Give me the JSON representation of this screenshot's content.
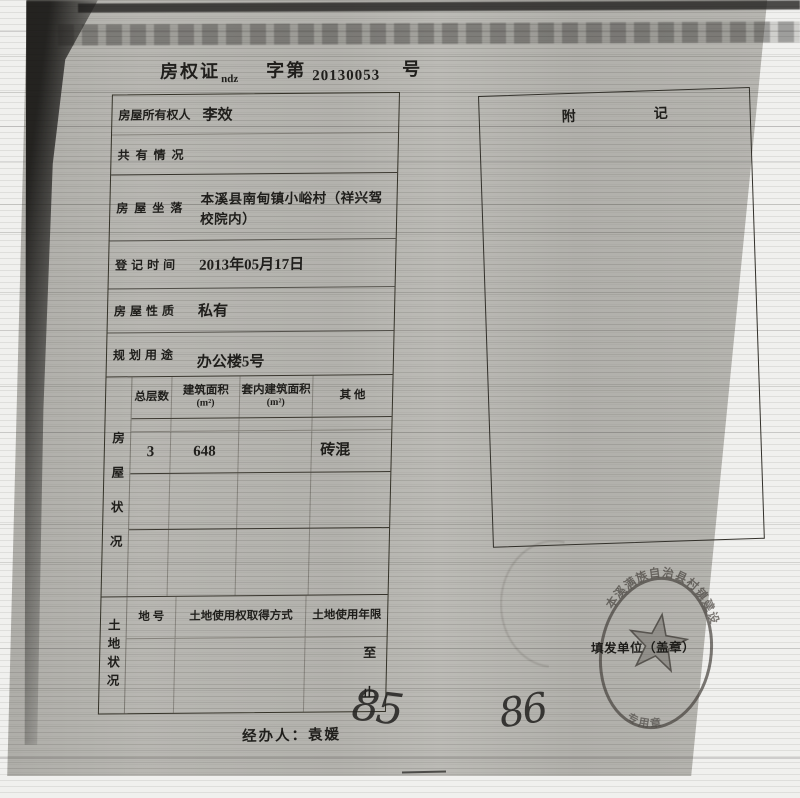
{
  "title": {
    "prefix": "房权证",
    "sub": "ndz",
    "middle": "字第",
    "number": "20130053",
    "suffix": "号"
  },
  "left_table": {
    "rows": [
      {
        "label": "房屋所有权人",
        "value": "李效"
      },
      {
        "label": "共有情况",
        "value": ""
      },
      {
        "label": "房屋坐落",
        "value": "本溪县南甸镇小峪村（祥兴驾校院内）"
      },
      {
        "label": "登记时间",
        "value": "2013年05月17日"
      },
      {
        "label": "房屋性质",
        "value": "私有"
      },
      {
        "label": "规划用途",
        "value": "办公楼5号"
      }
    ],
    "house_section": {
      "side_label": "房屋状况",
      "columns": [
        {
          "line1": "总层数",
          "line2": ""
        },
        {
          "line1": "建筑面积",
          "line2": "(m²)"
        },
        {
          "line1": "套内建筑面积",
          "line2": "(m²)"
        },
        {
          "line1": "其 他",
          "line2": ""
        }
      ],
      "values": [
        "3",
        "648",
        "",
        "砖混"
      ]
    },
    "land_section": {
      "side_label": "土地状况",
      "columns": [
        "地 号",
        "土地使用权取得方式",
        "土地使用年限"
      ],
      "term_from": "至",
      "term_to": "止"
    }
  },
  "right_box": {
    "header_left": "附",
    "header_right": "记"
  },
  "stamp": {
    "ring_text_top": "本溪满族自治县村镇建设",
    "ring_text_bottom": "专用章",
    "issuer_label": "填发单位（盖章）"
  },
  "footer": {
    "handler_label": "经办人：",
    "handler_name": "袁媛",
    "handwritten_left": "85",
    "handwritten_right": "86"
  },
  "colors": {
    "paper": "#b6b5b0",
    "ink": "#201f1c",
    "stamp": "#45413c"
  }
}
